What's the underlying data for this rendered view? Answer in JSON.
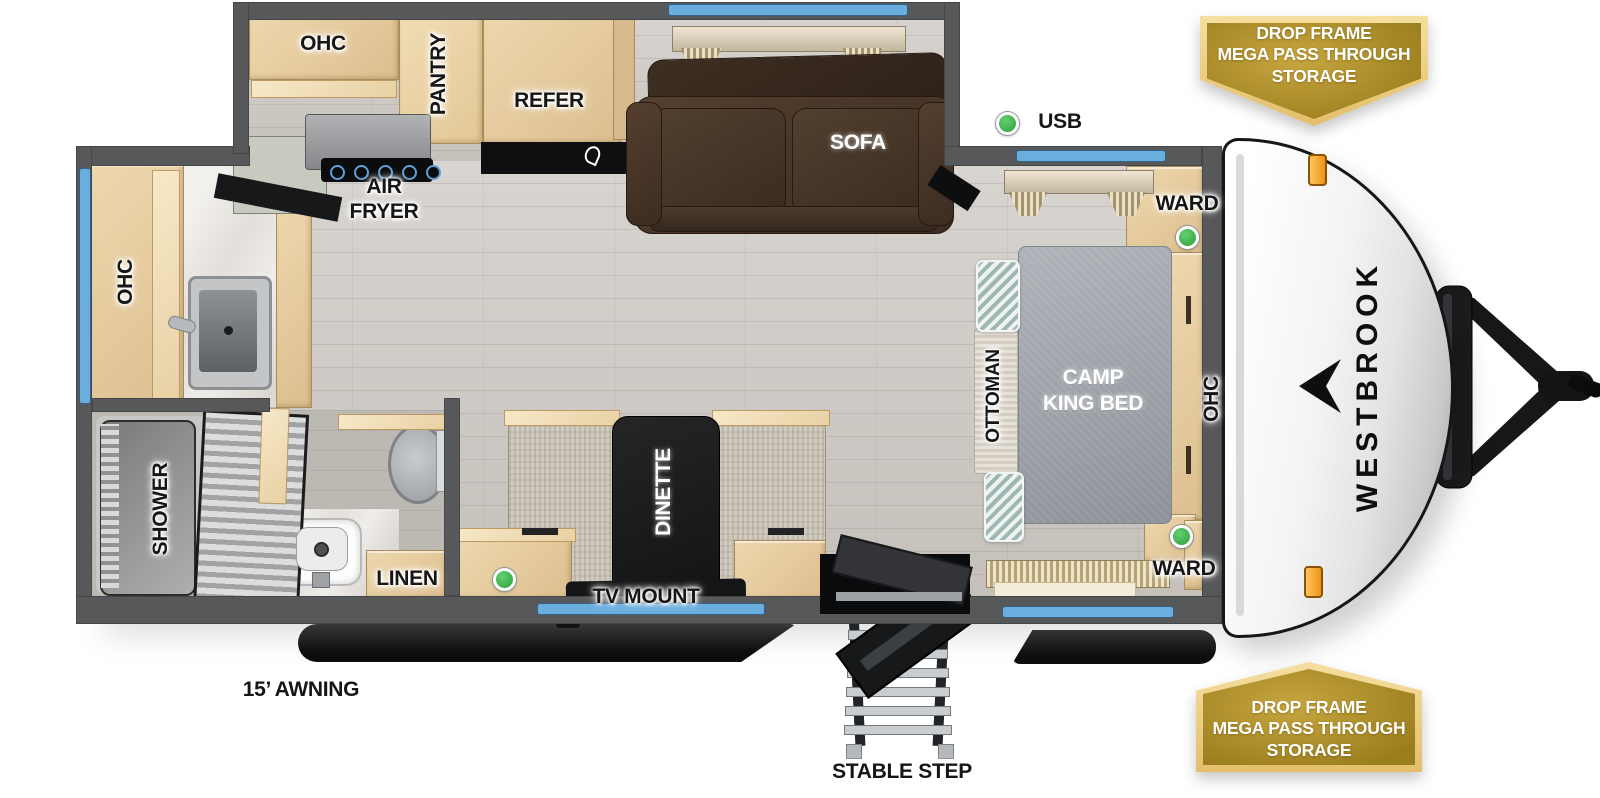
{
  "brand": {
    "name": "WESTBROOK"
  },
  "badges": {
    "top": {
      "lines": [
        "DROP FRAME",
        "MEGA PASS THROUGH",
        "STORAGE"
      ]
    },
    "bottom": {
      "lines": [
        "DROP FRAME",
        "MEGA PASS THROUGH",
        "STORAGE"
      ]
    }
  },
  "labels": {
    "ohc_kitchen": "OHC",
    "pantry": "PANTRY",
    "refer": "REFER",
    "air_fryer_line1": "AIR",
    "air_fryer_line2": "FRYER",
    "sofa": "SOFA",
    "usb": "USB",
    "ward_top": "WARD",
    "ward_bottom": "WARD",
    "bed_line1": "CAMP",
    "bed_line2": "KING BED",
    "ottoman": "OTTOMAN",
    "ohc_bedside": "OHC",
    "ohc_rear": "OHC",
    "dinette": "DINETTE",
    "tv_mount": "TV MOUNT",
    "shower": "SHOWER",
    "linen": "LINEN",
    "awning": "15’ AWNING",
    "stable_step": "STABLE STEP"
  },
  "colors": {
    "window_blue": "#6aaede",
    "usb_green": "#3db24b",
    "badge_gold": "#a98a26",
    "badge_trim": "#f0d78e",
    "wall_gray": "#57585a",
    "cabinet_wood": "#e6cda3",
    "sofa_brown": "#463529",
    "bed_gray": "#9ca3a9",
    "marker_amber": "#f5a623"
  }
}
